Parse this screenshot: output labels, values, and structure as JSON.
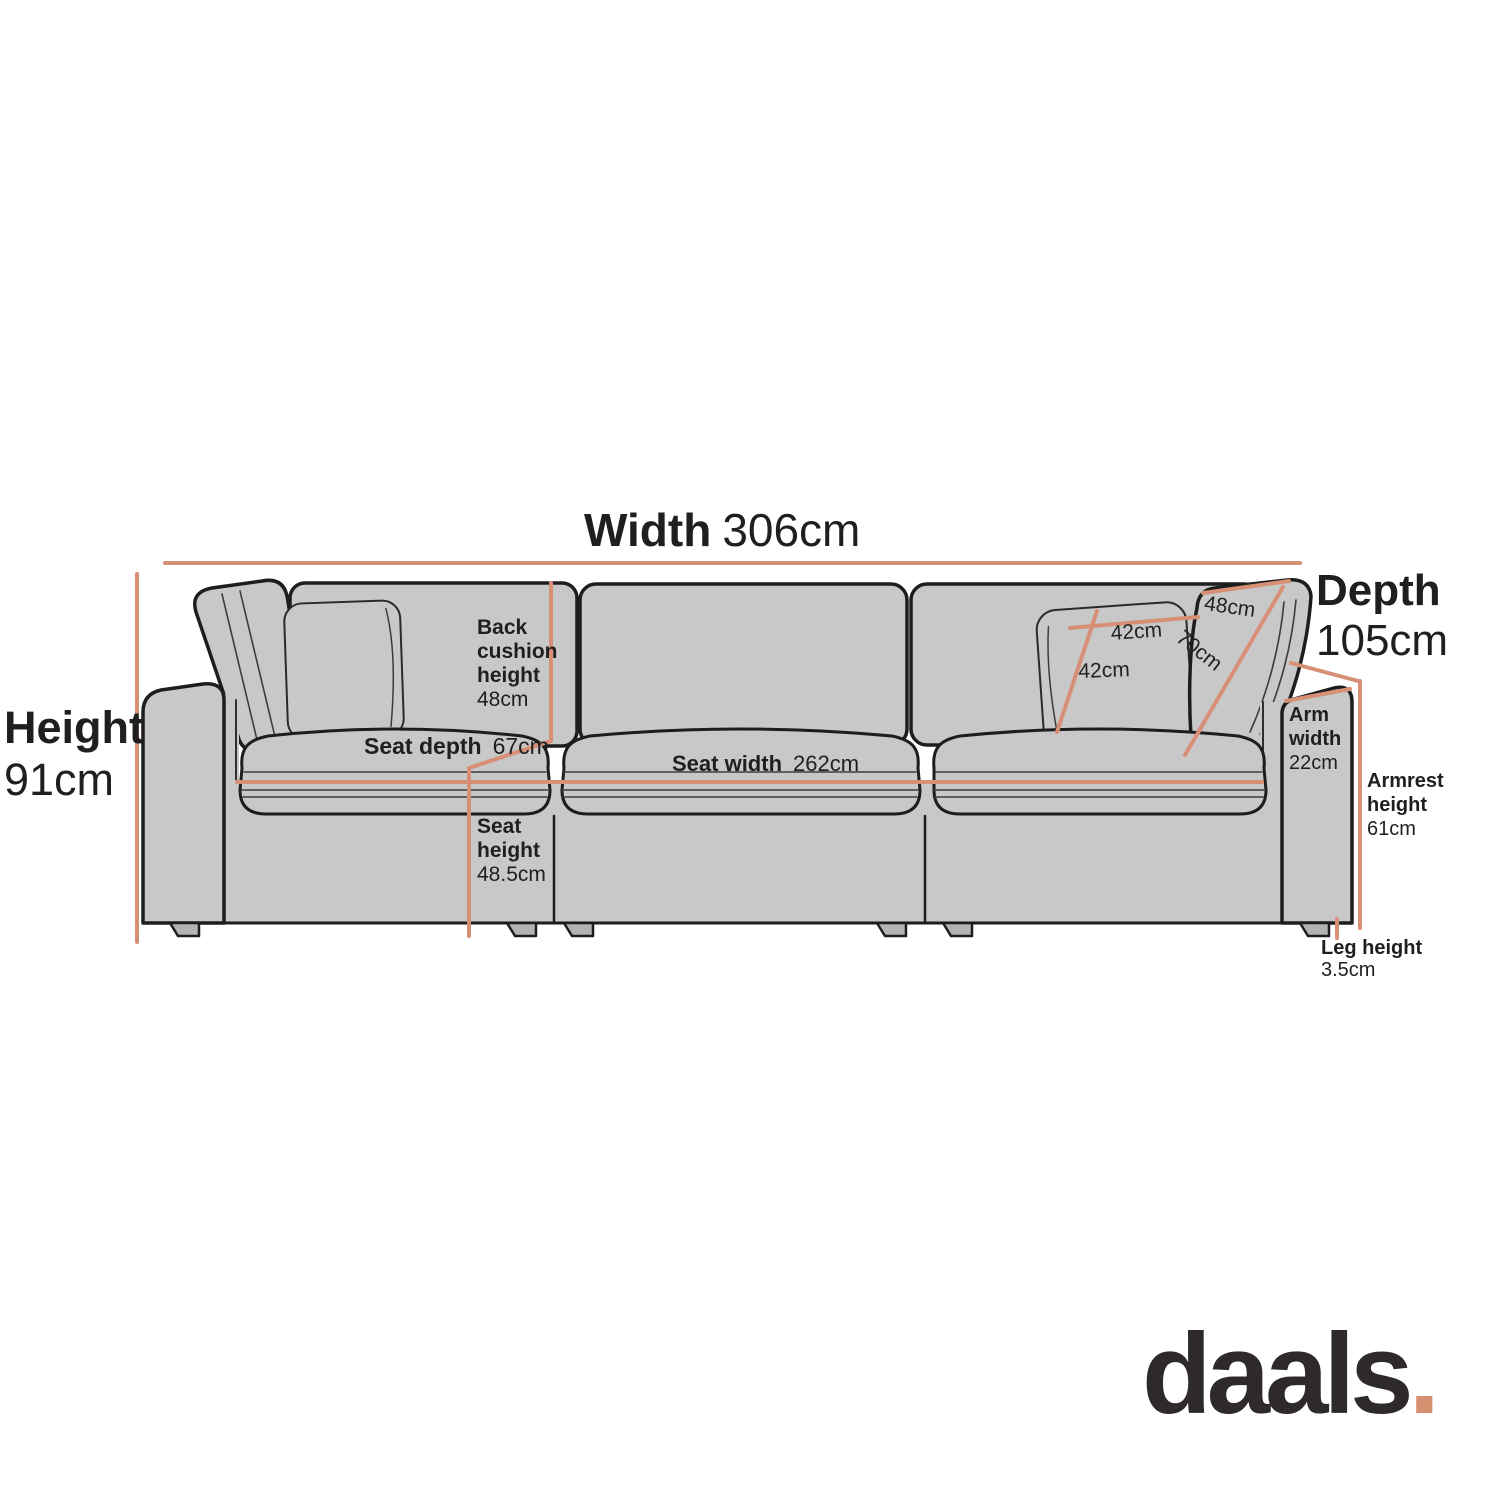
{
  "brand": {
    "name": "daals",
    "dot": "."
  },
  "colors": {
    "accent": "#d78f75",
    "sofa_fill": "#c8c8c8",
    "outline": "#1d1d1d",
    "text": "#1f1f1f"
  },
  "dimensions": {
    "width": {
      "label": "Width",
      "value": "306cm"
    },
    "depth": {
      "label": "Depth",
      "value": "105cm"
    },
    "height": {
      "label": "Height",
      "value": "91cm"
    },
    "back_cushion_height": {
      "label": "Back\ncushion\nheight",
      "value": "48cm"
    },
    "seat_depth": {
      "label": "Seat depth",
      "value": "67cm"
    },
    "seat_width": {
      "label": "Seat width",
      "value": "262cm"
    },
    "seat_height": {
      "label": "Seat\nheight",
      "value": "48.5cm"
    },
    "arm_width": {
      "label": "Arm\nwidth",
      "value": "22cm"
    },
    "armrest_height": {
      "label": "Armrest\nheight",
      "value": "61cm"
    },
    "leg_height": {
      "label": "Leg height",
      "value": "3.5cm"
    },
    "scatter_cushion_width": {
      "value": "42cm"
    },
    "scatter_cushion_height": {
      "value": "42cm"
    },
    "back_pillow_width": {
      "value": "48cm"
    },
    "back_pillow_length": {
      "value": "70cm"
    }
  }
}
